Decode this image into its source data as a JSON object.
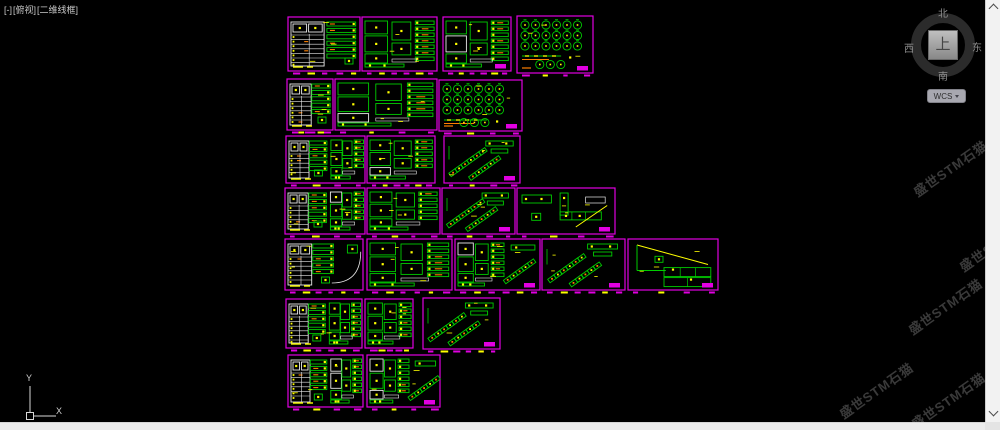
{
  "viewport_controls": {
    "minimized": "[-]",
    "view": "[俯视]",
    "visual_style": "[二维线框]"
  },
  "view_cube": {
    "north": "北",
    "south": "南",
    "east": "东",
    "west": "西",
    "top": "上",
    "wcs_label": "WCS"
  },
  "ucs_icon": {
    "x_label": "X",
    "y_label": "Y"
  },
  "watermark": {
    "text": "盛世STM石猫",
    "positions": [
      {
        "x": 950,
        "y": 168
      },
      {
        "x": 996,
        "y": 243
      },
      {
        "x": 945,
        "y": 306
      },
      {
        "x": 876,
        "y": 390
      },
      {
        "x": 948,
        "y": 400
      }
    ]
  },
  "colors": {
    "background": "#000000",
    "panel_border": "#e100e1",
    "green": "#00cd00",
    "yellow": "#ffff00",
    "orange": "#ff8000",
    "white": "#e8e8e8"
  },
  "panels": [
    {
      "x": 288,
      "y": 17,
      "w": 72,
      "h": 54,
      "motif": "table",
      "stamp": false
    },
    {
      "x": 362,
      "y": 17,
      "w": 75,
      "h": 54,
      "motif": "blocks",
      "stamp": false
    },
    {
      "x": 443,
      "y": 17,
      "w": 68,
      "h": 54,
      "motif": "blocks",
      "stamp": true
    },
    {
      "x": 517,
      "y": 16,
      "w": 76,
      "h": 57,
      "motif": "fans",
      "stamp": true
    },
    {
      "x": 287,
      "y": 79,
      "w": 46,
      "h": 51,
      "motif": "table",
      "stamp": false
    },
    {
      "x": 335,
      "y": 79,
      "w": 102,
      "h": 51,
      "motif": "blocks",
      "stamp": false
    },
    {
      "x": 439,
      "y": 80,
      "w": 83,
      "h": 51,
      "motif": "fans",
      "stamp": true
    },
    {
      "x": 286,
      "y": 136,
      "w": 79,
      "h": 47,
      "motif": "tableBlocks",
      "stamp": false
    },
    {
      "x": 367,
      "y": 136,
      "w": 68,
      "h": 47,
      "motif": "blocks",
      "stamp": false
    },
    {
      "x": 444,
      "y": 136,
      "w": 76,
      "h": 47,
      "motif": "diagonal",
      "stamp": true
    },
    {
      "x": 285,
      "y": 188,
      "w": 80,
      "h": 46,
      "motif": "tableBlocks",
      "stamp": false
    },
    {
      "x": 367,
      "y": 188,
      "w": 73,
      "h": 46,
      "motif": "blocks",
      "stamp": false
    },
    {
      "x": 442,
      "y": 188,
      "w": 73,
      "h": 46,
      "motif": "diagonal",
      "stamp": true
    },
    {
      "x": 517,
      "y": 188,
      "w": 98,
      "h": 46,
      "motif": "bigducts",
      "stamp": true
    },
    {
      "x": 285,
      "y": 239,
      "w": 78,
      "h": 51,
      "motif": "tableArc",
      "stamp": false
    },
    {
      "x": 367,
      "y": 239,
      "w": 85,
      "h": 51,
      "motif": "blocks",
      "stamp": false
    },
    {
      "x": 455,
      "y": 239,
      "w": 85,
      "h": 51,
      "motif": "blocksDiag",
      "stamp": true
    },
    {
      "x": 542,
      "y": 239,
      "w": 83,
      "h": 51,
      "motif": "diagonal",
      "stamp": true
    },
    {
      "x": 628,
      "y": 239,
      "w": 90,
      "h": 51,
      "motif": "triangle",
      "stamp": true
    },
    {
      "x": 286,
      "y": 299,
      "w": 76,
      "h": 49,
      "motif": "tableBlocks",
      "stamp": false
    },
    {
      "x": 365,
      "y": 299,
      "w": 48,
      "h": 49,
      "motif": "blocks",
      "stamp": false
    },
    {
      "x": 423,
      "y": 298,
      "w": 77,
      "h": 51,
      "motif": "diagonal",
      "stamp": true
    },
    {
      "x": 288,
      "y": 355,
      "w": 75,
      "h": 52,
      "motif": "tableBlocks",
      "stamp": false
    },
    {
      "x": 367,
      "y": 355,
      "w": 73,
      "h": 52,
      "motif": "blocksDiag",
      "stamp": true
    }
  ]
}
